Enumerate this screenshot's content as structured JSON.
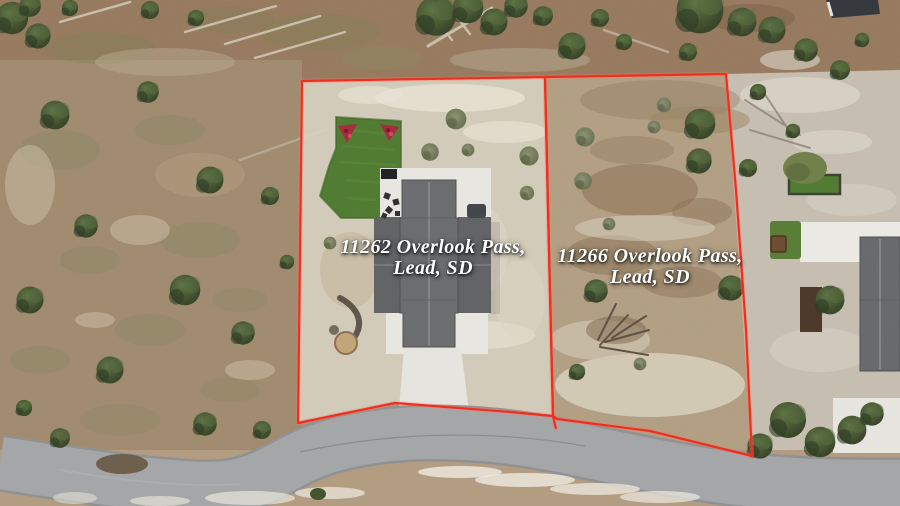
{
  "lots": [
    {
      "id": "11262",
      "line1": "11262 Overlook Pass,",
      "line2": "Lead, SD"
    },
    {
      "id": "11266",
      "line1": "11266 Overlook Pass,",
      "line2": "Lead, SD"
    }
  ],
  "colors": {
    "boundary": "#ed2b1d",
    "boundary_glow": "#ff7a60",
    "label_text": "#ffffff"
  }
}
